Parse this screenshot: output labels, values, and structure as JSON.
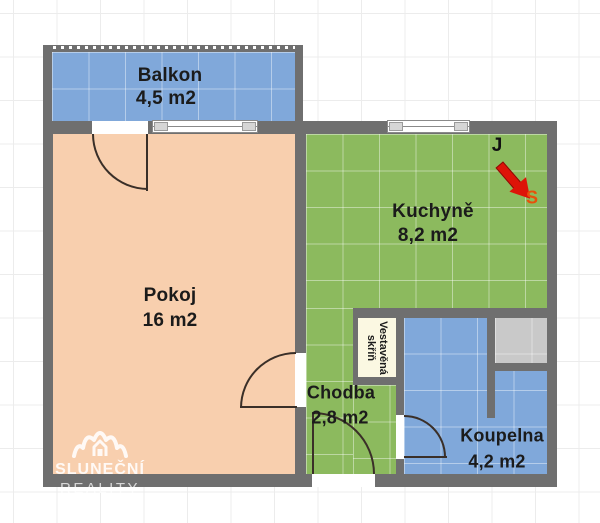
{
  "title": "Floor plan - 1+1 apartment",
  "rooms": {
    "balkon": {
      "name": "Balkon",
      "area": "4,5 m2"
    },
    "pokoj": {
      "name": "Pokoj",
      "area": "16 m2"
    },
    "kuchyne": {
      "name": "Kuchyně",
      "area": "8,2 m2"
    },
    "chodba": {
      "name": "Chodba",
      "area": "2,8 m2"
    },
    "koupelna": {
      "name": "Koupelna",
      "area": "4,2 m2"
    },
    "vestavena_skrin": {
      "line1": "Vestavěná",
      "line2": "skříň"
    }
  },
  "compass": {
    "label_top": "J",
    "label_bottom": "S"
  },
  "watermark": {
    "line1": "SLUNEČNÍ",
    "line2": "REALITY"
  },
  "colors": {
    "wall": "#6f6f6f",
    "balcony_bathroom_fill": "#80a8da",
    "kitchen_hall_fill": "#8cba5e",
    "room_fill": "#f8cfae",
    "shaft_fill": "#c9c9c9",
    "wardrobe_fill": "#fbf8e2",
    "arrow_red": "#dd1408",
    "compass_s_color": "#e8500a",
    "label_color": "#1b1b1b"
  }
}
